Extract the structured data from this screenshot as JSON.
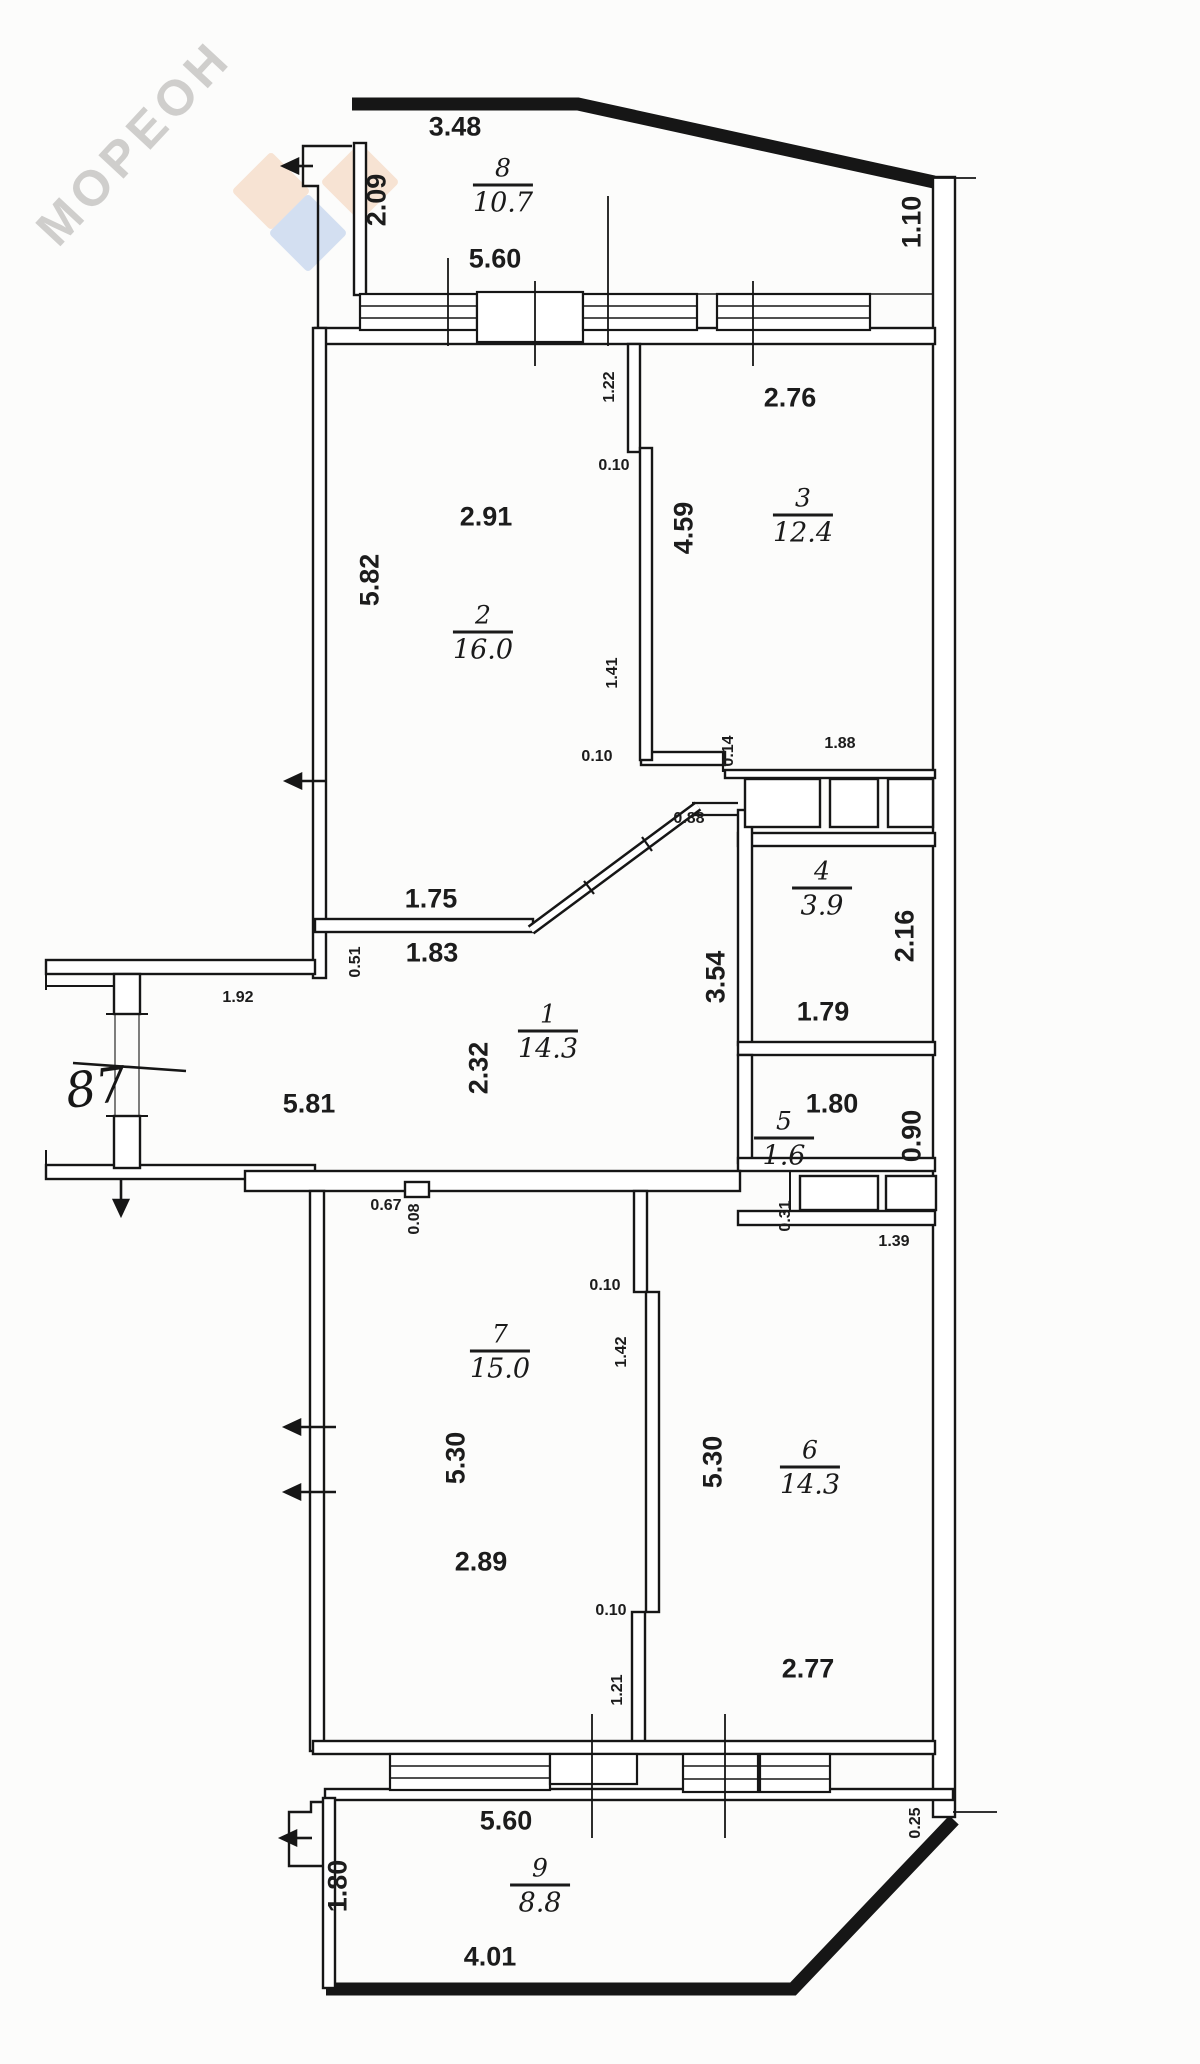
{
  "watermark": {
    "text": "МОРЕОН",
    "letters_color": "#aaa8a6",
    "diamond_peach": "#f7e3d3",
    "diamond_blue": "#d3dff1"
  },
  "apartment_number": "87",
  "rooms": {
    "hall": {
      "number": "1",
      "area": "14.3",
      "dims": {
        "seg_a": "1.75",
        "seg_b": "1.83",
        "jog": "0.51",
        "entry_width": "1.92",
        "length": "5.81",
        "width": "2.32",
        "right_height": "3.54"
      }
    },
    "living": {
      "number": "2",
      "area": "16.0",
      "dims": {
        "width": "2.91",
        "height": "5.82",
        "part_top": "1.22",
        "part_step": "0.10",
        "part_mid": "1.41",
        "wall": "0.10"
      }
    },
    "bedroom_top": {
      "number": "3",
      "area": "12.4",
      "dims": {
        "width": "2.76",
        "height": "4.59"
      }
    },
    "storage": {
      "number": "4",
      "area": "3.9",
      "dims": {
        "height": "2.16",
        "width": "1.79",
        "closet_width": "1.88",
        "step": "0.14",
        "door": "0.88"
      }
    },
    "wc": {
      "number": "5",
      "area": "1.6",
      "dims": {
        "width": "1.80",
        "height": "0.90",
        "step": "0.31",
        "closet_width": "1.39"
      }
    },
    "bedroom_right": {
      "number": "6",
      "area": "14.3",
      "dims": {
        "height": "5.30",
        "width": "2.77",
        "part_step": "0.10",
        "part_low": "1.21"
      }
    },
    "bedroom_left": {
      "number": "7",
      "area": "15.0",
      "dims": {
        "height": "5.30",
        "width": "2.89",
        "notch_width": "0.67",
        "notch_depth": "0.08",
        "part_step": "0.10",
        "part_mid": "1.42"
      }
    },
    "balcony_top": {
      "number": "8",
      "area": "10.7",
      "dims": {
        "top": "3.48",
        "left": "2.09",
        "bottom": "5.60",
        "right": "1.10"
      }
    },
    "balcony_bottom": {
      "number": "9",
      "area": "8.8",
      "dims": {
        "top": "5.60",
        "left": "1.80",
        "bottom": "4.01",
        "right": "0.25"
      }
    }
  }
}
